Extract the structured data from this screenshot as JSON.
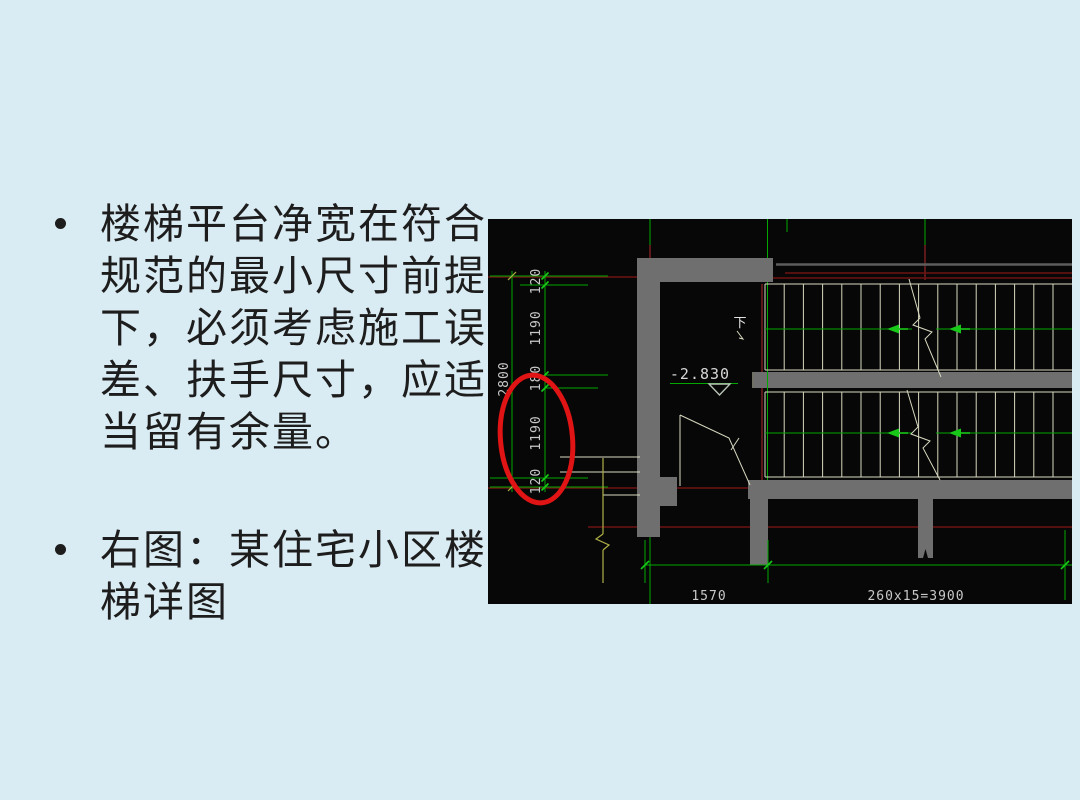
{
  "slide": {
    "background_color": "#daecf3",
    "text_color": "#1d1d1d",
    "bullet1_lines": [
      "楼梯平台净宽在符合",
      "规范的最小尺寸前提",
      "下，必须考虑施工误",
      "差、扶手尺寸，应适",
      "当留有余量。"
    ],
    "bullet2_lines": [
      "右图：某住宅小区楼",
      "梯详图"
    ]
  },
  "cad": {
    "background_color": "#070707",
    "colors": {
      "dimension_green": "#00a800",
      "arrow_green": "#18c818",
      "axis_red": "#6e1212",
      "wall_gray": "#6f6f6f",
      "tread_cream": "#d8d8c0",
      "dim_text_gray": "#c8c8c8",
      "highlight_ellipse_red": "#e01414"
    },
    "dims_left": [
      "120",
      "1190",
      "180",
      "1190",
      "120"
    ],
    "dim_total": "2800",
    "level_mark": "-2.830",
    "direction_label": "下",
    "dim_bottom_left": "1570",
    "dim_bottom_right": "260x15=3900",
    "stairs": {
      "tread_lines": 17,
      "tread_spacing": 19.2
    }
  }
}
